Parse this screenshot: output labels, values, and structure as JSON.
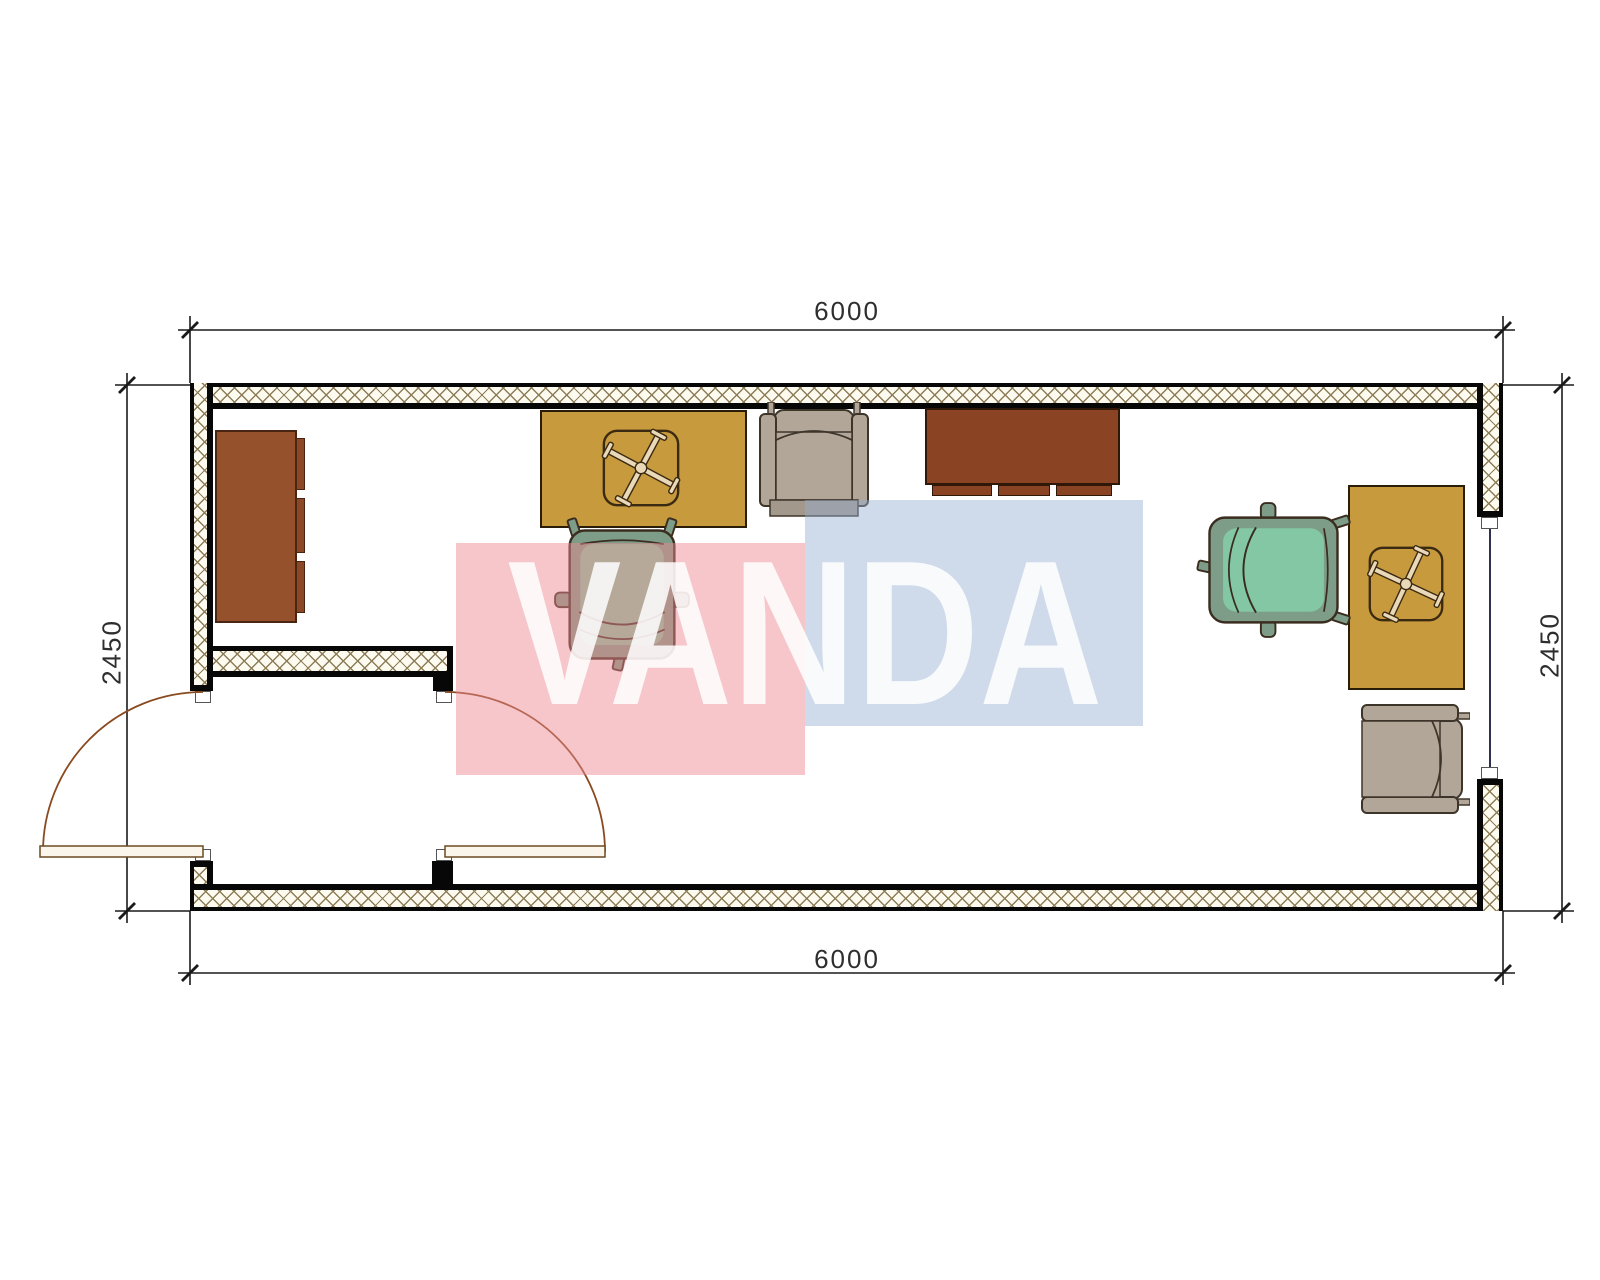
{
  "drawing": {
    "type": "architectural floor plan, top view, single room container office 6000 x 2450",
    "dimensions": {
      "top": "6000",
      "bottom": "6000",
      "left": "2450",
      "right": "2450"
    },
    "watermark": {
      "text": "VANDA",
      "pink_color": "#ec8791",
      "blue_color": "#94add0",
      "text_color": "#ffffff"
    },
    "colors": {
      "wall_hatch_line": "#8d7d58",
      "wall_fill": "#fdfaf0",
      "wall_outline": "#070707",
      "desk": "#c79a3d",
      "cabinet": "#94512c",
      "sideboard": "#8a4424",
      "armchair": "#b2a698",
      "office_chair_shell": "#7e9d88",
      "office_chair_seat": "#84c7a4",
      "door_arc": "#8a4a1f",
      "window_line": "#2f2f4f",
      "dimension_line": "#1a1a1a"
    },
    "furniture": [
      {
        "name": "wardrobe-cabinet",
        "position": "left wall"
      },
      {
        "name": "office-desk-1",
        "position": "top left, with chair cross symbol"
      },
      {
        "name": "office-chair-1",
        "position": "below desk 1, facing north"
      },
      {
        "name": "armchair-1",
        "position": "top wall, facing south"
      },
      {
        "name": "sideboard",
        "position": "top wall center-right"
      },
      {
        "name": "office-chair-2",
        "position": "right area, facing east"
      },
      {
        "name": "office-desk-2",
        "position": "right wall, with chair cross symbol"
      },
      {
        "name": "armchair-2",
        "position": "bottom right, facing west"
      }
    ],
    "openings": [
      {
        "name": "entrance-double-door",
        "position": "bottom left vestibule"
      },
      {
        "name": "window",
        "position": "right wall"
      }
    ]
  }
}
